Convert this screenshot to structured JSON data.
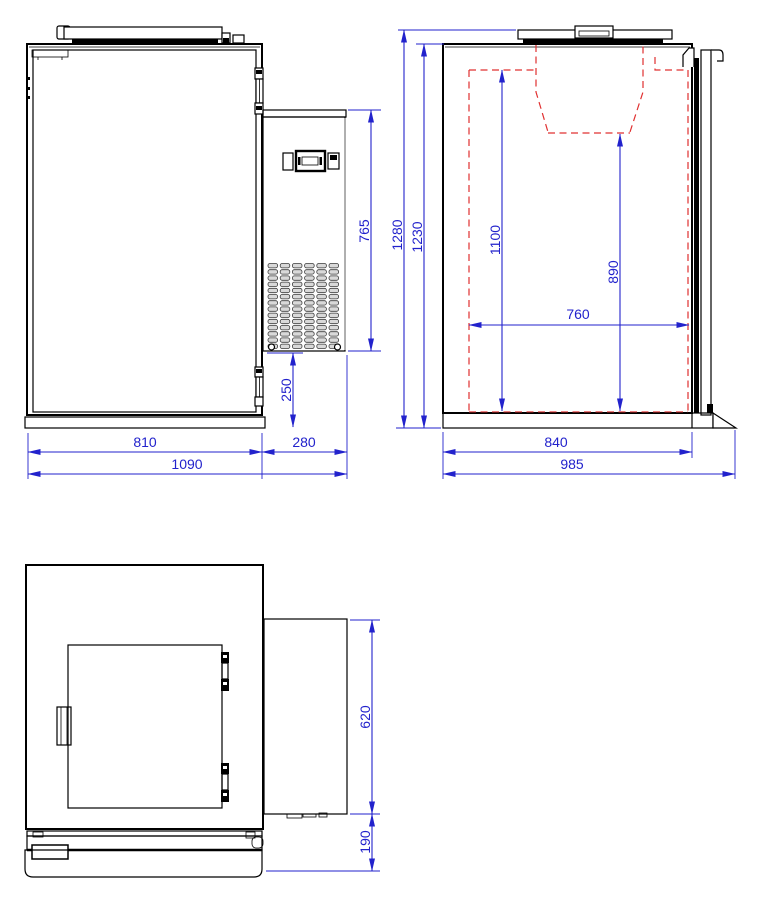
{
  "colors": {
    "dimension_blue": "#2222cc",
    "hidden_line_red": "#e03030",
    "drawing_black": "#000000",
    "background": "#ffffff"
  },
  "dimensions": {
    "front_view": {
      "cabinet_width": "810",
      "condensing_unit_width": "280",
      "total_width": "1090",
      "condensing_unit_height": "765",
      "base_height": "250"
    },
    "side_view": {
      "total_height": "1280",
      "body_height": "1230",
      "interior_height": "1100",
      "interior_height_under_hopper": "890",
      "interior_depth": "760",
      "body_depth": "840",
      "total_depth": "985"
    },
    "plan_view": {
      "condensing_unit_depth": "620",
      "door_front_depth": "190"
    }
  }
}
